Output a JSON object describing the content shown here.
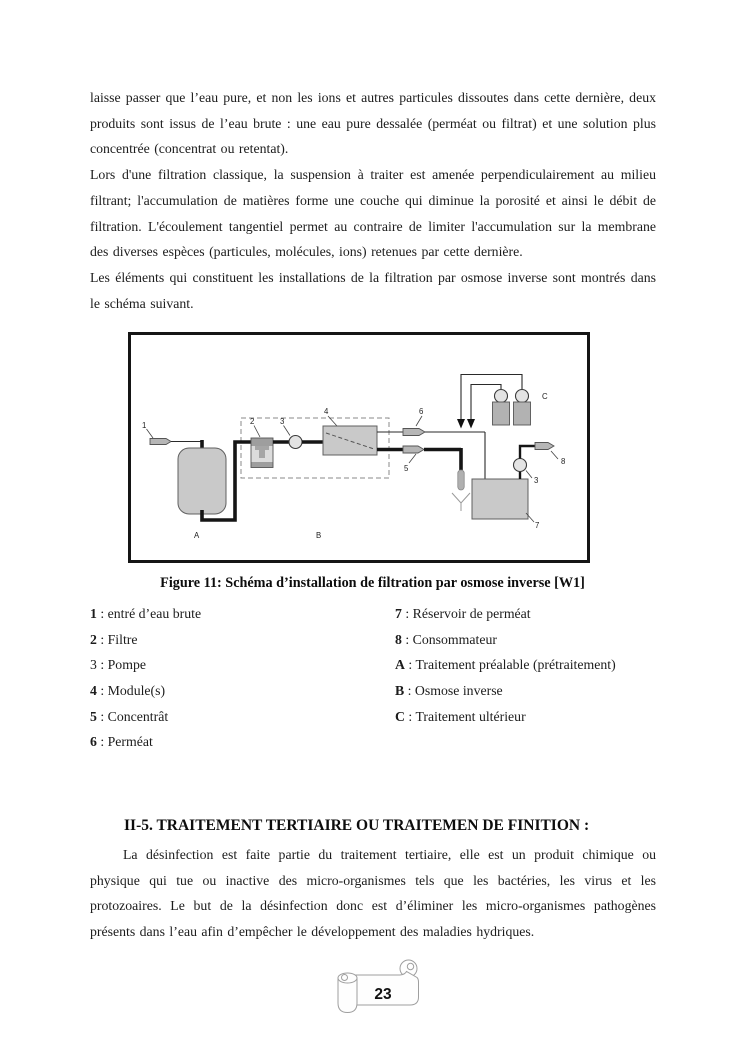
{
  "content": {
    "para1": "laisse passer que l’eau pure, et non les ions et autres particules dissoutes dans cette dernière, deux produits sont issus de l’eau brute : une eau pure dessalée (perméat ou filtrat) et une solution plus concentrée (concentrat ou retentat).",
    "para2": "Lors d'une filtration classique, la suspension à traiter est amenée perpendiculairement au milieu filtrant; l'accumulation de matières forme une couche qui diminue la porosité et ainsi le débit de filtration. L'écoulement tangentiel permet au contraire de limiter l'accumulation sur la membrane des diverses espèces (particules, molécules, ions) retenues par cette dernière.",
    "para3": "Les éléments qui constituent les installations de la filtration par osmose inverse sont montrés dans le schéma suivant."
  },
  "figure": {
    "caption": "Figure 11: Schéma d’installation de filtration par osmose inverse [W1]",
    "labels": {
      "n1": "1",
      "n2": "2",
      "n3": "3",
      "n4": "4",
      "n5": "5",
      "n6": "6",
      "n7": "7",
      "n8": "8",
      "n3b": "3",
      "a": "A",
      "b": "B",
      "c": "C"
    }
  },
  "legend": {
    "left": [
      {
        "key": "1",
        "desc": " : entré d’eau brute"
      },
      {
        "key": "2",
        "desc": " : Filtre"
      },
      {
        "key": "3",
        "desc": " : Pompe"
      },
      {
        "key": "4",
        "desc": " : Module(s)"
      },
      {
        "key": "5",
        "desc": " : Concentrât"
      },
      {
        "key": "6",
        "desc": " : Perméat"
      }
    ],
    "right": [
      {
        "key": "7",
        "desc": " : Réservoir de perméat"
      },
      {
        "key": "8",
        "desc": " : Consommateur"
      },
      {
        "key": "A",
        "desc": " : Traitement préalable (prétraitement)"
      },
      {
        "key": "B",
        "desc": " : Osmose inverse"
      },
      {
        "key": "C",
        "desc": " : Traitement ultérieur"
      }
    ]
  },
  "section": {
    "heading": "II-5. TRAITEMENT TERTIAIRE OU TRAITEMEN DE FINITION :",
    "body": "La désinfection est faite partie du traitement tertiaire, elle est un produit chimique ou physique qui tue ou inactive des micro-organismes tels que les bactéries, les virus et les protozoaires. Le but de la désinfection donc est d’éliminer les micro-organismes pathogènes présents dans l’eau afin d’empêcher le développement des maladies hydriques."
  },
  "footer": {
    "page_number": "23"
  },
  "colors": {
    "diagram_fill": "#c9c9c9",
    "diagram_fill_dark": "#9e9e9e",
    "pipe": "#151515",
    "page_text": "#1c1c1c"
  }
}
